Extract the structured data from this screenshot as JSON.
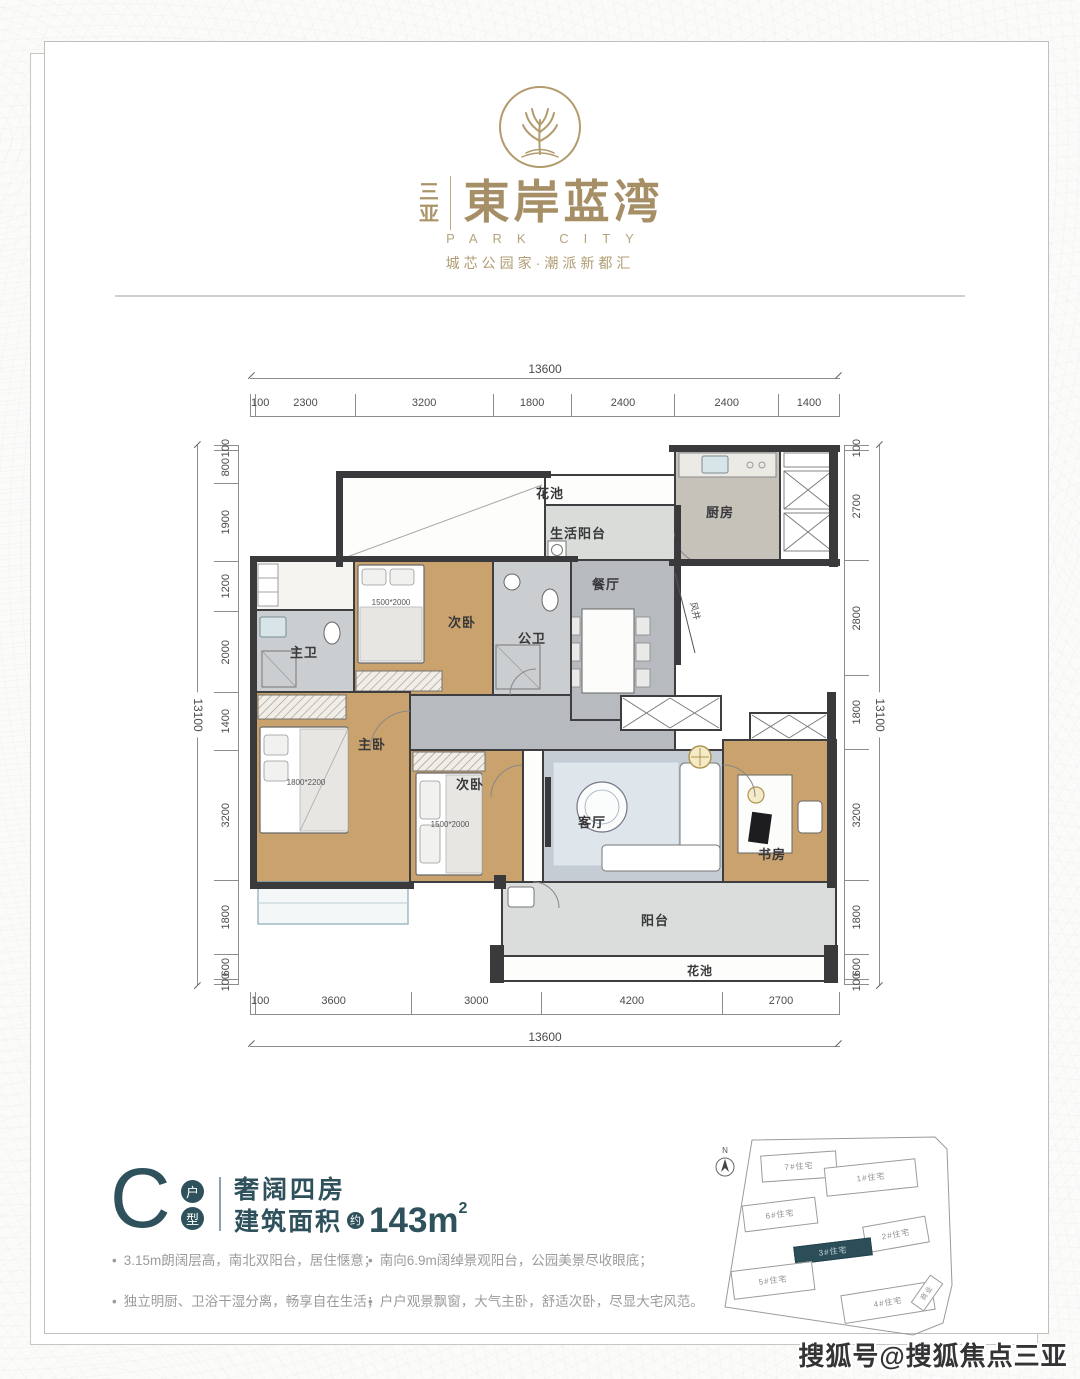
{
  "brand": {
    "city": "三亚",
    "name": "東岸蓝湾",
    "latin": "PARK CITY",
    "tagline": "城芯公园家·潮派新都汇",
    "gold": "#ab9468"
  },
  "plan": {
    "rooms": {
      "flower_top": "花池",
      "service_balcony": "生活阳台",
      "kitchen": "厨房",
      "dining": "餐厅",
      "guest_bath": "公卫",
      "bedroom_top": "次卧",
      "master_bath": "主卫",
      "master": "主卧",
      "bedroom_low": "次卧",
      "living": "客厅",
      "study": "书房",
      "balcony": "阳台",
      "flower_bottom": "花池",
      "shaft": "风井"
    },
    "beds": {
      "bedroom_top": "1500*2000",
      "master": "1800*2200",
      "bedroom_low": "1500*2000"
    },
    "dims": {
      "top_total": "13600",
      "top_segments": [
        "100",
        "2300",
        "3200",
        "1800",
        "2400",
        "2400",
        "1400"
      ],
      "bottom_total": "13600",
      "bottom_segments": [
        "100",
        "3600",
        "3000",
        "4200",
        "2700"
      ],
      "left_total": "13100",
      "left_segments": [
        "100",
        "800",
        "1900",
        "1200",
        "2000",
        "1400",
        "3200",
        "1800",
        "600",
        "100"
      ],
      "right_total": "13100",
      "right_segments": [
        "100",
        "2700",
        "2800",
        "1800",
        "3200",
        "1800",
        "600",
        "100"
      ]
    }
  },
  "unit": {
    "letter": "C",
    "type_top": "户",
    "type_bottom": "型",
    "headline": "奢阔四房",
    "area_prefix": "建筑面积",
    "area_approx": "约",
    "area_value": "143m",
    "area_sup": "2",
    "teal": "#2e515c",
    "features_left": [
      "3.15m朗阔层高，南北双阳台，居住惬意；",
      "独立明厨、卫浴干湿分离，畅享自在生活；"
    ],
    "features_right": [
      "南向6.9m阔绰景观阳台，公园美景尽收眼底；",
      "户户观景飘窗，大气主卧，舒适次卧，尽显大宅风范。"
    ]
  },
  "siteplan": {
    "north": "N",
    "buildings": [
      {
        "label": "7#住宅",
        "highlight": false
      },
      {
        "label": "1#住宅",
        "highlight": false
      },
      {
        "label": "6#住宅",
        "highlight": false
      },
      {
        "label": "2#住宅",
        "highlight": false
      },
      {
        "label": "3#住宅",
        "highlight": true
      },
      {
        "label": "5#住宅",
        "highlight": false
      },
      {
        "label": "4#住宅",
        "highlight": false
      },
      {
        "label": "商业",
        "highlight": false
      }
    ]
  },
  "watermark": "搜狐号@搜狐焦点三亚站"
}
